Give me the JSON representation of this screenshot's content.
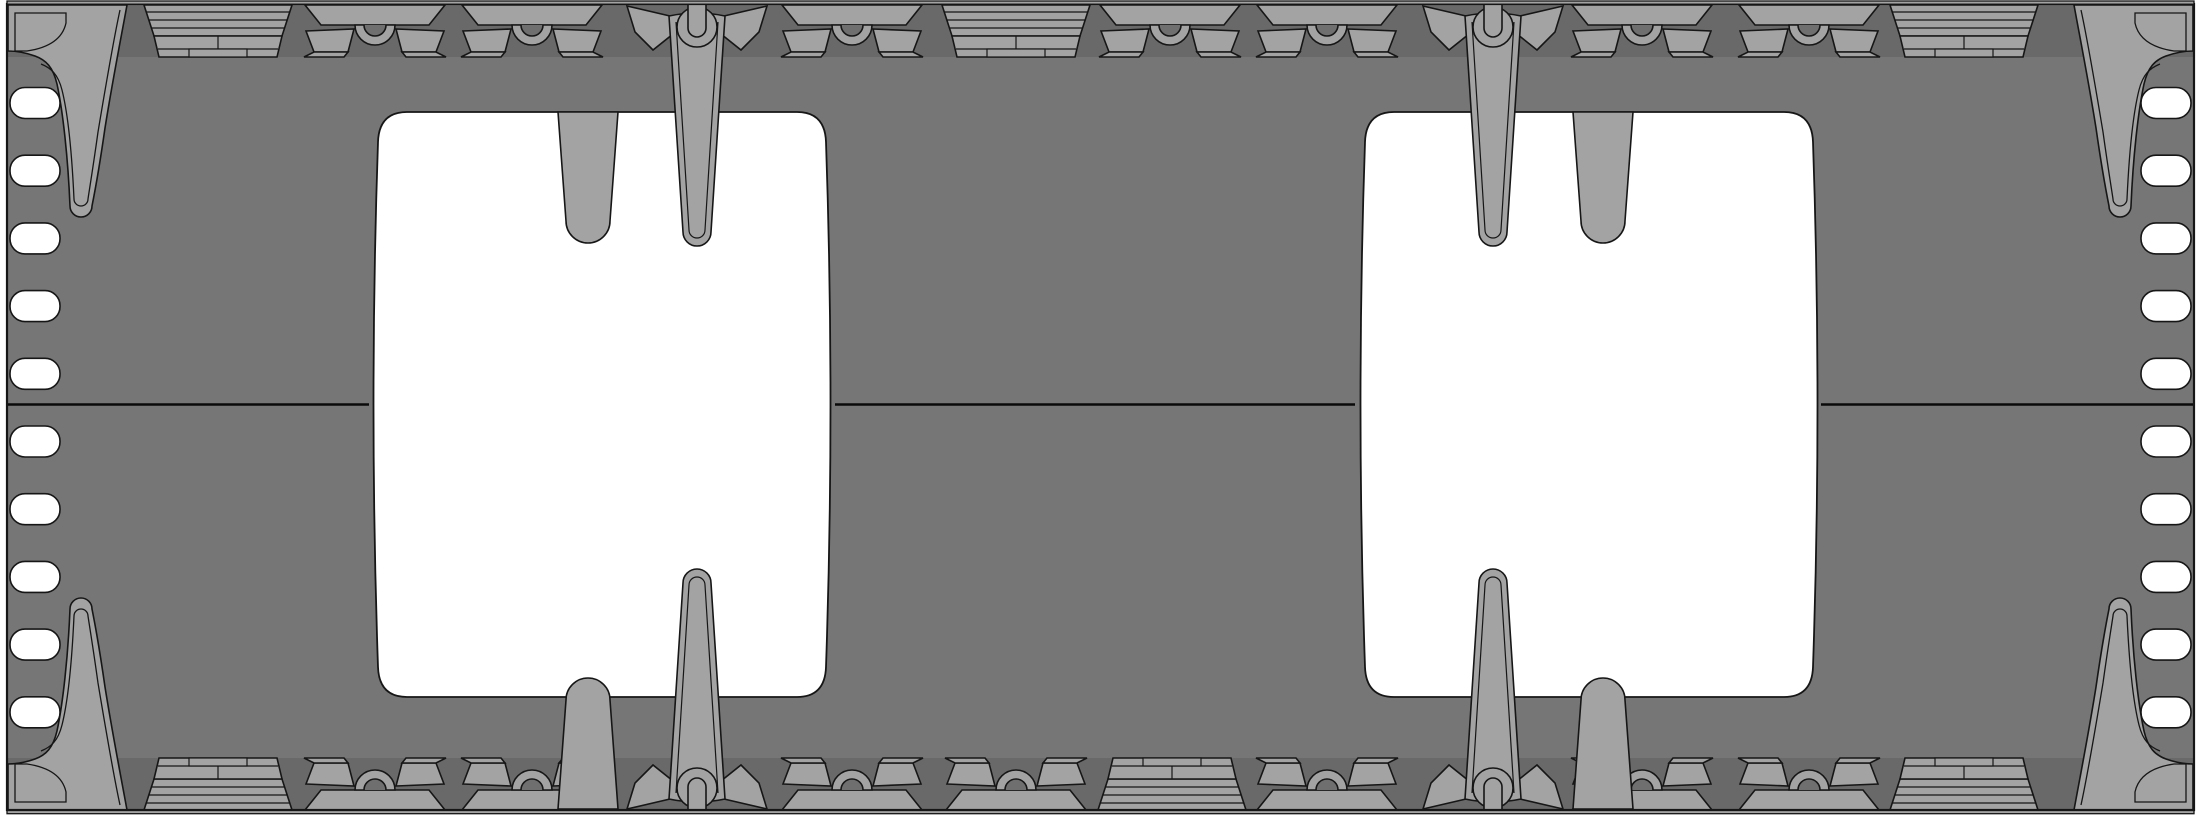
{
  "meta": {
    "type": "technical-drawing",
    "subject": "molded tray frame, orthographic top view",
    "visible_text": "none"
  },
  "canvas": {
    "width": 2201,
    "height": 815,
    "background": "#ffffff"
  },
  "colors": {
    "plate": "#767676",
    "edge_strip": "#696969",
    "feature": "#a3a3a3",
    "notch": "#6f6f6f",
    "outline": "#161616",
    "cutout": "#ffffff",
    "slot": "#ffffff",
    "parting_line": "#0a0a0a",
    "cap": "#a3a3a3"
  },
  "plate": {
    "x": 7,
    "y": 4,
    "width": 2187,
    "height": 806
  },
  "cap_strips": [
    {
      "y": 1,
      "h": 3.2
    },
    {
      "y": 810.5,
      "h": 3.2
    }
  ],
  "edge_strips": [
    {
      "y": 5,
      "h": 52
    },
    {
      "y": 758,
      "h": 52
    }
  ],
  "parting_line": {
    "y": 404.5,
    "thickness": 2.4,
    "segments": [
      [
        7,
        369
      ],
      [
        835,
        1355
      ],
      [
        1821,
        2194
      ]
    ]
  },
  "edge_slots": {
    "count_per_side": 10,
    "width": 50,
    "height": 31,
    "rx": 15,
    "left_x": 10,
    "right_x": 2141,
    "first_cy": 103,
    "pitch": 67.7
  },
  "cutouts": [
    {
      "cx": 602,
      "top": 112,
      "bottom": 697,
      "width": 450,
      "corner_radius": 30,
      "side_bulge": 8
    },
    {
      "cx": 1589,
      "top": 112,
      "bottom": 697,
      "width": 450,
      "corner_radius": 30,
      "side_bulge": 8
    }
  ],
  "fingers": {
    "top_x": [
      588,
      1603
    ],
    "bottom_x": [
      588,
      1603
    ],
    "base_y": 112,
    "length": 131,
    "half_width_base": 30,
    "half_width_tip": 22
  },
  "top_edge_features": [
    {
      "type": "block",
      "x": 218
    },
    {
      "type": "latch",
      "x": 375
    },
    {
      "type": "latch",
      "x": 532
    },
    {
      "type": "pin",
      "x": 697
    },
    {
      "type": "latch",
      "x": 852
    },
    {
      "type": "block",
      "x": 1016
    },
    {
      "type": "latch",
      "x": 1170
    },
    {
      "type": "latch",
      "x": 1327
    },
    {
      "type": "pin",
      "x": 1493
    },
    {
      "type": "latch",
      "x": 1642
    },
    {
      "type": "latch",
      "x": 1809
    },
    {
      "type": "block",
      "x": 1964
    }
  ],
  "bottom_edge_features": [
    {
      "type": "block",
      "x": 218
    },
    {
      "type": "latch",
      "x": 375
    },
    {
      "type": "latch",
      "x": 532
    },
    {
      "type": "pin",
      "x": 697
    },
    {
      "type": "latch",
      "x": 852
    },
    {
      "type": "latch",
      "x": 1016
    },
    {
      "type": "block",
      "x": 1172
    },
    {
      "type": "latch",
      "x": 1327
    },
    {
      "type": "pin",
      "x": 1493
    },
    {
      "type": "latch",
      "x": 1642
    },
    {
      "type": "latch",
      "x": 1809
    },
    {
      "type": "block",
      "x": 1964
    }
  ],
  "corner_gussets": [
    "top-left",
    "top-right",
    "bottom-left",
    "bottom-right"
  ],
  "pin_geometry": {
    "shaft_top_half_width": 28,
    "shaft_tip_half_width": 14,
    "tip_y": 246,
    "boss_radius": 20,
    "u_channel_half_width": 9
  },
  "latch_geometry": {
    "half_width": 77,
    "height": 52,
    "hump_radius": 20,
    "hump_notch_radius": 11
  },
  "block_geometry": {
    "half_width": 74,
    "height": 52,
    "bar_lines": 3
  }
}
